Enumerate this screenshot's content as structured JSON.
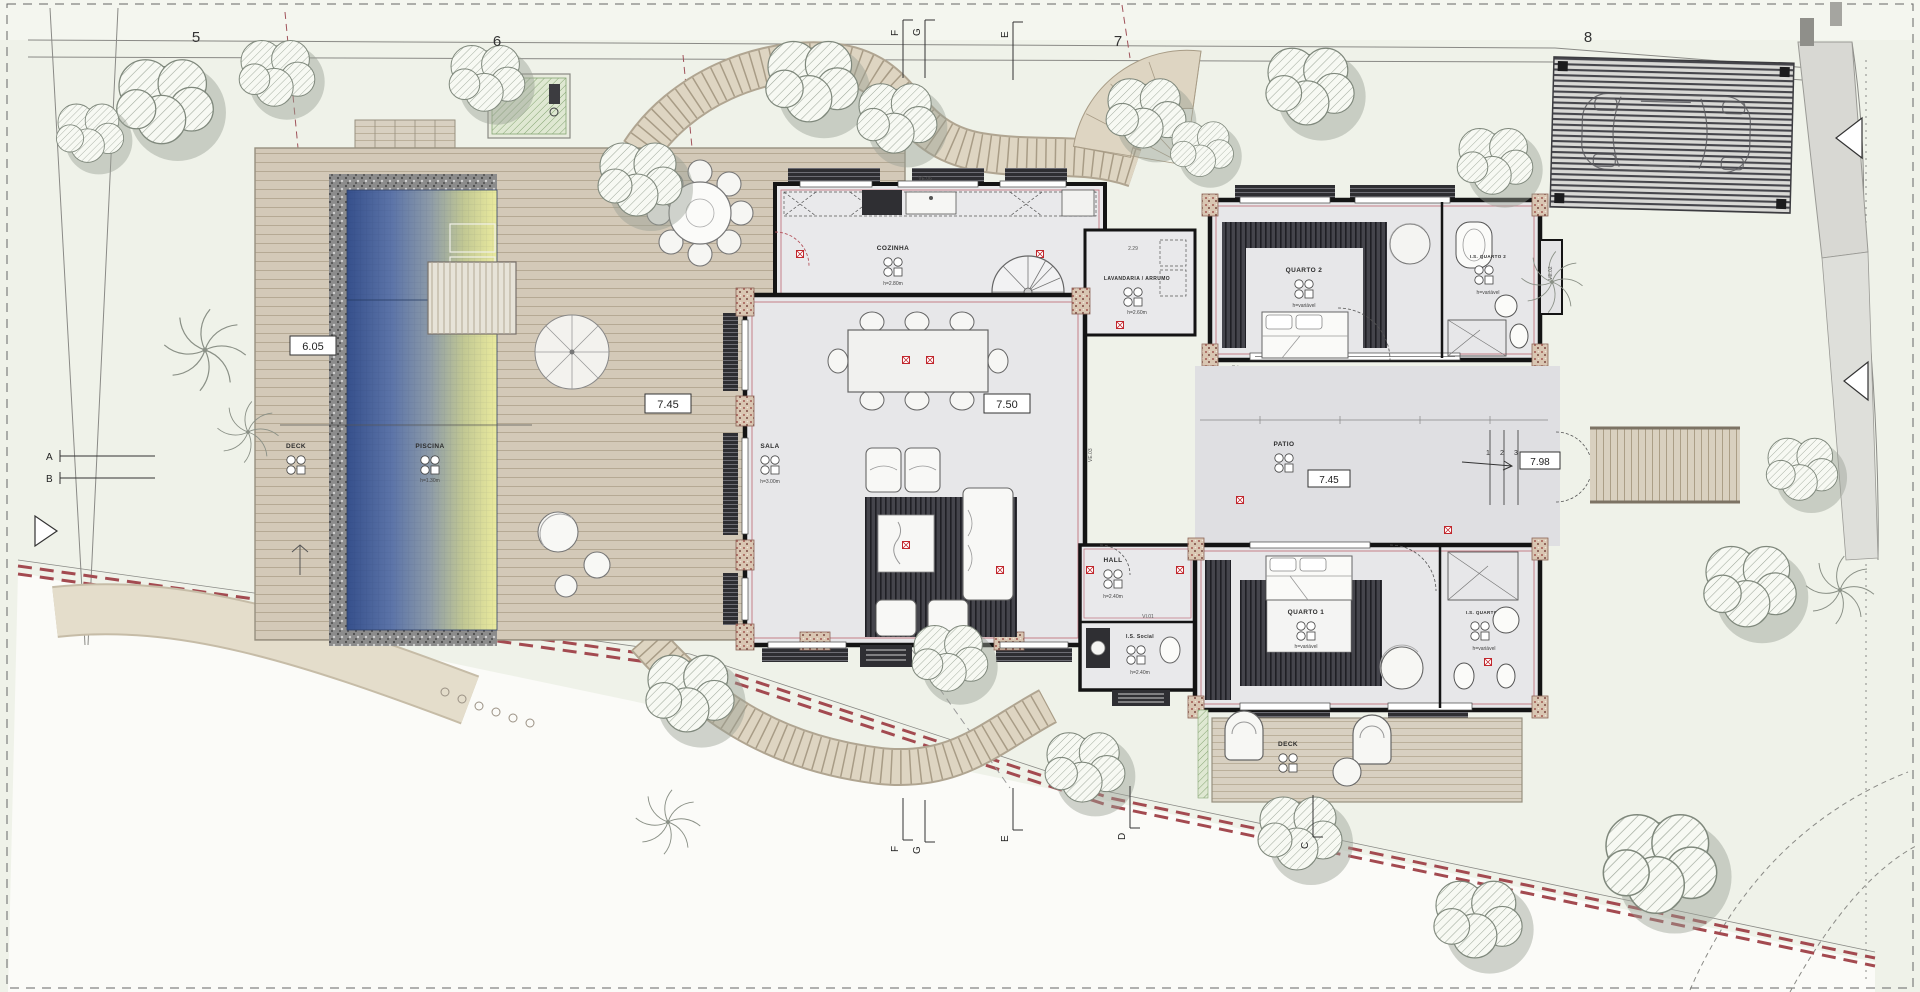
{
  "grid": {
    "numbers": [
      "5",
      "6",
      "7",
      "8"
    ]
  },
  "markers": {
    "top": [
      "F",
      "G",
      "E"
    ],
    "left": [
      "A",
      "B"
    ],
    "bottom": [
      "F",
      "G",
      "E",
      "D",
      "C"
    ]
  },
  "dimensions": {
    "pool_deck_width": "6.05",
    "deck_length": "7.45",
    "sala_width": "7.50",
    "patio_width": "7.45",
    "patio_exit": "7.98",
    "laundry": "2.29"
  },
  "patio_steps": [
    "1",
    "2",
    "3"
  ],
  "windows": {
    "ve06": "VE.06",
    "ve03": "VE.03",
    "ve04": "VE.04",
    "ve02": "VE.02",
    "ve12": "VE.12",
    "vi01": "VI.01"
  },
  "rooms": {
    "cozinha": {
      "label": "COZINHA",
      "height": "h=2.80m"
    },
    "lavandaria": {
      "label": "LAVANDARIA / ARRUMO",
      "height": "h=2.60m"
    },
    "sala": {
      "label": "SALA",
      "height": "h=3.00m"
    },
    "quarto2": {
      "label": "QUARTO 2",
      "height": "h=variável"
    },
    "is_quarto2": {
      "label": "I.S. QUARTO 2",
      "height": "h=variável"
    },
    "patio": {
      "label": "PATIO"
    },
    "quarto1": {
      "label": "QUARTO 1",
      "height": "h=variável"
    },
    "is_quarto1": {
      "label": "I.S. QUARTO 1",
      "height": "h=variável"
    },
    "hall": {
      "label": "HALL",
      "height": "h=2.40m"
    },
    "is_social": {
      "label": "I.S. Social",
      "height": "h=2.40m"
    },
    "piscina": {
      "label": "PISCINA",
      "height": "h=1.30m"
    },
    "deck_pool": {
      "label": "DECK"
    },
    "deck_quartos": {
      "label": "DECK"
    }
  },
  "colors": {
    "boundary_red": "#a34a50",
    "accent_red": "#c1272d",
    "wall_black": "#141414",
    "pool_deep": "#36508c",
    "pool_shallow": "#ebeb9e",
    "deck_wood": "#d3c9b8",
    "site_green": "#e9ede1"
  }
}
